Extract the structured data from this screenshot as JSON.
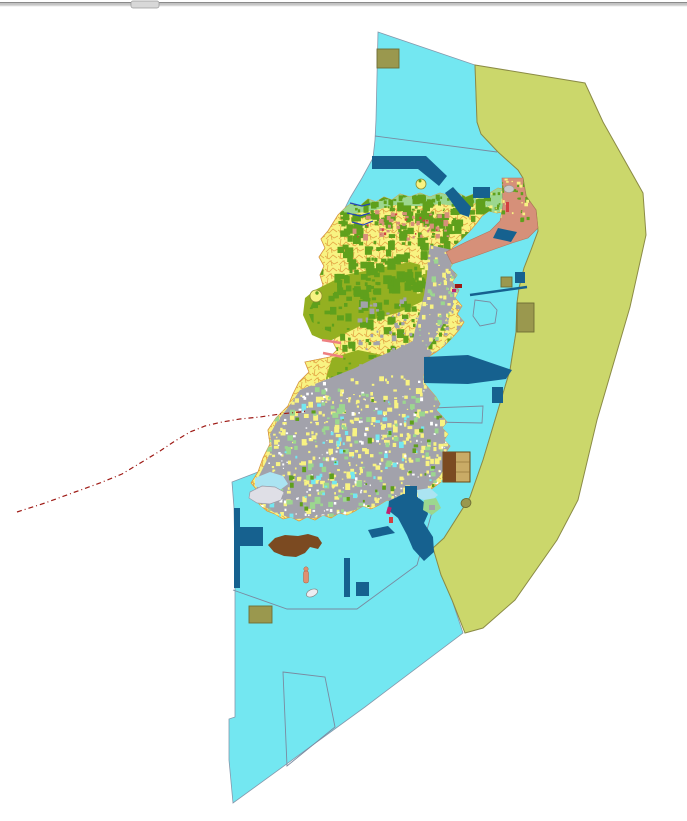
{
  "window": {
    "top_bar": {
      "description": "thin gray window edge bar with small drag tab",
      "tab_color": "#D8D8D8"
    }
  },
  "palette": {
    "background": "#FFFFFF",
    "water": "#73E7F1",
    "line_gray": "#7A8AA0",
    "zone": "#CBD76B",
    "zone_edge": "#8B8B45",
    "deep_blue": "#16618F",
    "khaki": "#9A984E",
    "khaki_edge": "#6E6D35",
    "salmon": "#D69079",
    "salmon_edge": "#B5765C",
    "island_yellow": "#F8F382",
    "parcel_line": "#E09A3C",
    "forest": "#5FA01C",
    "olive_patch": "#94B021",
    "urban_gray": "#A2A2AB",
    "light_green": "#9CD78F",
    "brown": "#7B4A21",
    "tan": "#C9AB66",
    "tan_edge": "#6B4A14",
    "red_line": "#9E1A15",
    "stream": "#2244BB",
    "pink": "#EE8080",
    "magenta": "#C02070",
    "crimson": "#D34040",
    "light_gray": "#DFDFE6",
    "gray_edge": "#9A9AA6",
    "lightblue": "#ABE4F2",
    "bar_dark": "#8A8A8A",
    "bar_mid": "#C6C6C6",
    "bar_tab": "#D8D8D8"
  },
  "map": {
    "type": "land-use-zoning-map",
    "layers": [
      {
        "name": "ocean-water",
        "color_key": "water"
      },
      {
        "name": "coastal-planning-zone-band",
        "color_key": "zone"
      },
      {
        "name": "island-parcels",
        "color_key": "island_yellow"
      },
      {
        "name": "forest-patches",
        "color_key": "forest"
      },
      {
        "name": "agricultural-olive-patches",
        "color_key": "olive_patch"
      },
      {
        "name": "urban-area",
        "color_key": "urban_gray"
      },
      {
        "name": "coastal-green-strip",
        "color_key": "light_green"
      },
      {
        "name": "port-breakwaters-and-piers",
        "color_key": "deep_blue"
      },
      {
        "name": "special-use-salmon-zone",
        "color_key": "salmon"
      },
      {
        "name": "khaki-designated-plots",
        "color_key": "khaki"
      },
      {
        "name": "municipal-boundary-dashed-line",
        "color_key": "red_line"
      },
      {
        "name": "streams",
        "color_key": "stream"
      },
      {
        "name": "marine-parcel-boundaries",
        "color_key": "line_gray"
      }
    ],
    "speckle_layers": [
      {
        "name": "strip-darkgreen",
        "into": "spk-strip",
        "clip": "island",
        "color": "forest",
        "x": 345,
        "y": 194,
        "w": 140,
        "h": 16,
        "n": 60,
        "s": 3
      },
      {
        "name": "ne-tip-green",
        "into": "spk-strip",
        "clip": "island",
        "color": "forest",
        "x": 476,
        "y": 190,
        "w": 42,
        "h": 24,
        "n": 26,
        "s": 3.5
      },
      {
        "name": "ne-tip-yellow",
        "into": "spk-strip",
        "clip": "island",
        "color": "island_yellow",
        "x": 476,
        "y": 190,
        "w": 42,
        "h": 24,
        "n": 22,
        "s": 3
      },
      {
        "name": "forest-north-a",
        "into": "spk-north",
        "clip": "island",
        "color": "forest",
        "x": 336,
        "y": 194,
        "w": 152,
        "h": 96,
        "n": 300,
        "s": 7
      },
      {
        "name": "forest-north-b",
        "into": "spk-north",
        "clip": "island",
        "color": "forest",
        "x": 298,
        "y": 268,
        "w": 150,
        "h": 80,
        "n": 130,
        "s": 6
      },
      {
        "name": "forest-mid",
        "into": "spk-north",
        "clip": "island",
        "color": "forest",
        "x": 330,
        "y": 348,
        "w": 70,
        "h": 85,
        "n": 45,
        "s": 5
      },
      {
        "name": "salmon-north",
        "into": "spk-north",
        "clip": "island",
        "color": "salmon",
        "x": 352,
        "y": 210,
        "w": 95,
        "h": 28,
        "n": 40,
        "s": 4
      },
      {
        "name": "red-north",
        "into": "spk-north",
        "clip": "island",
        "color": "crimson",
        "x": 356,
        "y": 212,
        "w": 85,
        "h": 24,
        "n": 16,
        "s": 2
      },
      {
        "name": "gray-mid",
        "into": "spk-north",
        "clip": "island",
        "color": "urban_gray",
        "x": 355,
        "y": 295,
        "w": 110,
        "h": 70,
        "n": 90,
        "s": 4
      },
      {
        "name": "yellow-south",
        "into": "spk-south",
        "clip": "island",
        "color": "island_yellow",
        "x": 258,
        "y": 375,
        "w": 200,
        "h": 142,
        "n": 400,
        "s": 4
      },
      {
        "name": "white-south",
        "into": "spk-south",
        "clip": "island",
        "color": "#FFFFFF",
        "x": 258,
        "y": 380,
        "w": 200,
        "h": 135,
        "n": 150,
        "s": 2.5
      },
      {
        "name": "green-south",
        "into": "spk-south",
        "clip": "island",
        "color": "light_green",
        "x": 262,
        "y": 385,
        "w": 195,
        "h": 130,
        "n": 110,
        "s": 5
      },
      {
        "name": "cyan-south",
        "into": "spk-south",
        "clip": "island",
        "color": "water",
        "x": 265,
        "y": 400,
        "w": 185,
        "h": 115,
        "n": 60,
        "s": 4
      },
      {
        "name": "forest-south",
        "into": "spk-south",
        "clip": "island",
        "color": "forest",
        "x": 280,
        "y": 395,
        "w": 170,
        "h": 115,
        "n": 40,
        "s": 4
      },
      {
        "name": "yellow-east",
        "into": "spk-south",
        "clip": "island",
        "color": "island_yellow",
        "x": 416,
        "y": 243,
        "w": 48,
        "h": 110,
        "n": 90,
        "s": 3
      },
      {
        "name": "green-east",
        "into": "spk-south",
        "clip": "island",
        "color": "light_green",
        "x": 418,
        "y": 250,
        "w": 45,
        "h": 100,
        "n": 30,
        "s": 3.5
      },
      {
        "name": "salmon-mosaic-green",
        "into": "spk-salmon",
        "clip": "salmon",
        "color": "forest",
        "x": 478,
        "y": 178,
        "w": 50,
        "h": 40,
        "n": 30,
        "s": 3.5
      },
      {
        "name": "salmon-mosaic-yellow",
        "into": "spk-salmon",
        "clip": "salmon",
        "color": "island_yellow",
        "x": 478,
        "y": 178,
        "w": 50,
        "h": 40,
        "n": 26,
        "s": 3
      }
    ]
  }
}
